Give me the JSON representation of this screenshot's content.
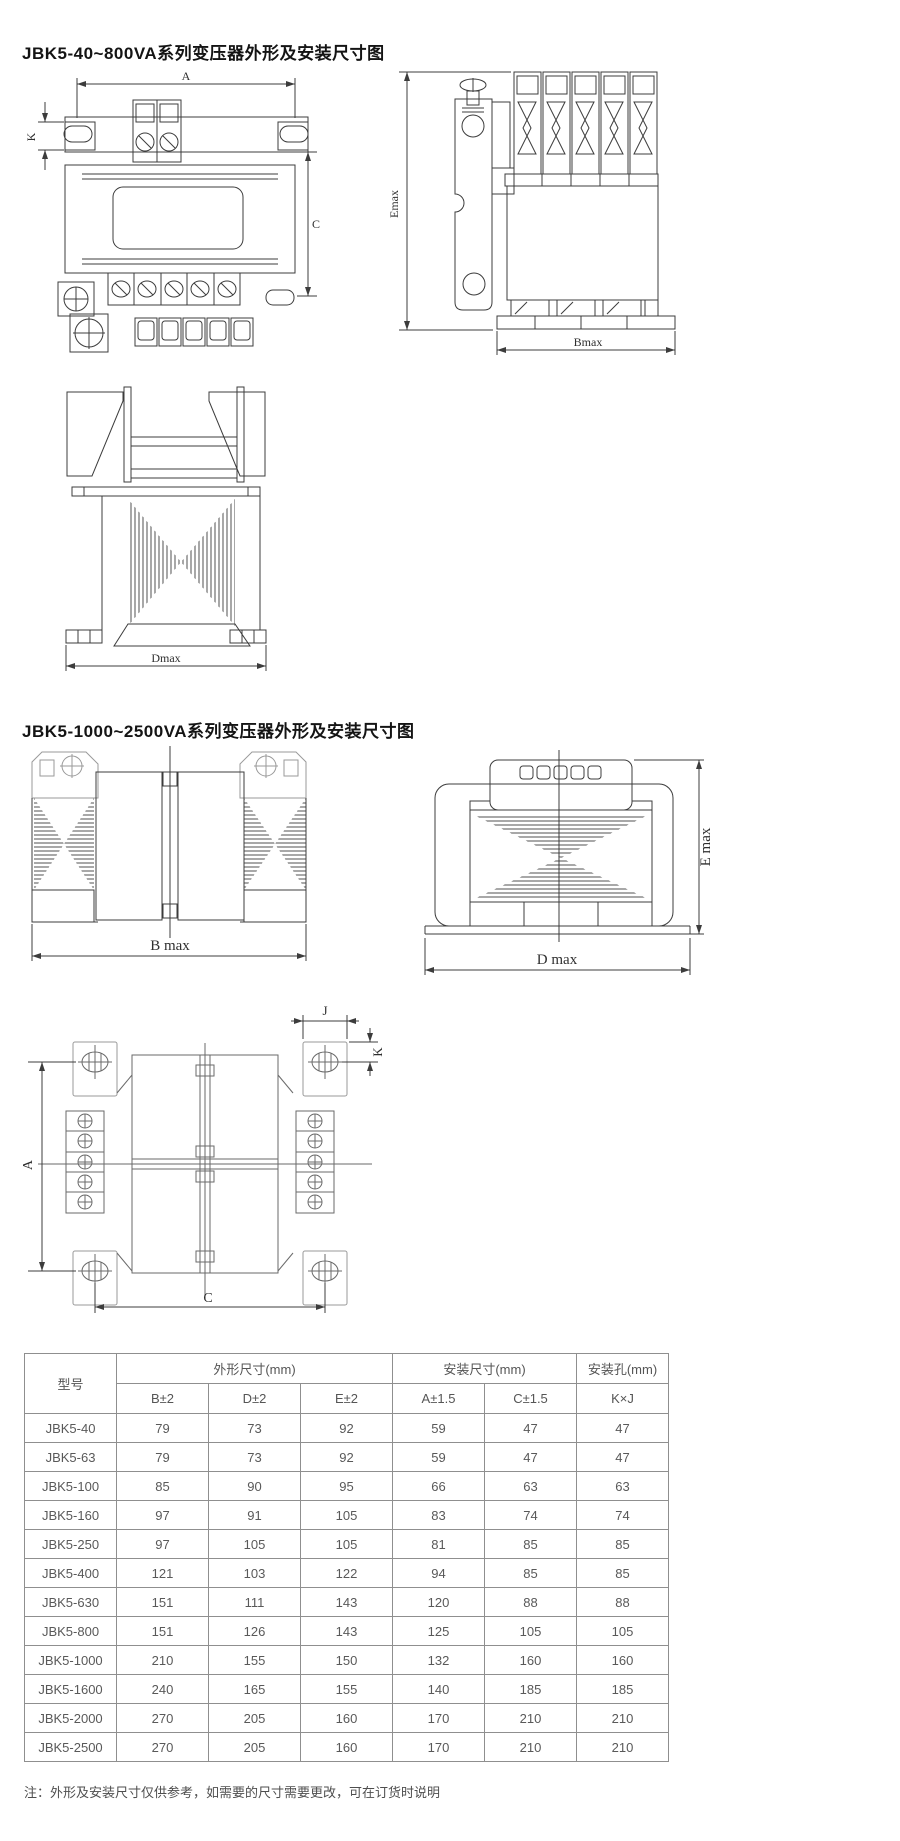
{
  "page": {
    "title_small_series": "JBK5-40~800VA系列变压器外形及安装尺寸图",
    "title_large_series": "JBK5-1000~2500VA系列变压器外形及安装尺寸图",
    "footnote": "注：外形及安装尺寸仅供参考，如需要的尺寸需要更改，可在订货时说明"
  },
  "colors": {
    "line": "#3c3c3c",
    "pad_grey": "#9a9a9a",
    "table_border": "#8f8f8f",
    "table_text": "#595959"
  },
  "dimensions": {
    "small_front": {
      "a": "A",
      "k": "K",
      "c": "C"
    },
    "small_side": {
      "emax": "Emax",
      "bmax": "Bmax"
    },
    "small_top": {
      "dmax": "Dmax"
    },
    "large_top": {
      "bmax": "B max"
    },
    "large_front": {
      "dmax": "D max",
      "emax": "E max"
    },
    "mounting": {
      "j": "J",
      "k": "K",
      "a": "A",
      "c": "C"
    }
  },
  "table": {
    "header_model": "型号",
    "group_outline": "外形尺寸(mm)",
    "group_mount": "安装尺寸(mm)",
    "group_hole": "安装孔(mm)",
    "sub": [
      "B±2",
      "D±2",
      "E±2",
      "A±1.5",
      "C±1.5",
      "K×J"
    ],
    "rows": [
      {
        "model": "JBK5-40",
        "b": "79",
        "d": "73",
        "e": "92",
        "a": "59",
        "c": "47",
        "kj": "47"
      },
      {
        "model": "JBK5-63",
        "b": "79",
        "d": "73",
        "e": "92",
        "a": "59",
        "c": "47",
        "kj": "47"
      },
      {
        "model": "JBK5-100",
        "b": "85",
        "d": "90",
        "e": "95",
        "a": "66",
        "c": "63",
        "kj": "63"
      },
      {
        "model": "JBK5-160",
        "b": "97",
        "d": "91",
        "e": "105",
        "a": "83",
        "c": "74",
        "kj": "74"
      },
      {
        "model": "JBK5-250",
        "b": "97",
        "d": "105",
        "e": "105",
        "a": "81",
        "c": "85",
        "kj": "85"
      },
      {
        "model": "JBK5-400",
        "b": "121",
        "d": "103",
        "e": "122",
        "a": "94",
        "c": "85",
        "kj": "85"
      },
      {
        "model": "JBK5-630",
        "b": "151",
        "d": "111",
        "e": "143",
        "a": "120",
        "c": "88",
        "kj": "88"
      },
      {
        "model": "JBK5-800",
        "b": "151",
        "d": "126",
        "e": "143",
        "a": "125",
        "c": "105",
        "kj": "105"
      },
      {
        "model": "JBK5-1000",
        "b": "210",
        "d": "155",
        "e": "150",
        "a": "132",
        "c": "160",
        "kj": "160"
      },
      {
        "model": "JBK5-1600",
        "b": "240",
        "d": "165",
        "e": "155",
        "a": "140",
        "c": "185",
        "kj": "185"
      },
      {
        "model": "JBK5-2000",
        "b": "270",
        "d": "205",
        "e": "160",
        "a": "170",
        "c": "210",
        "kj": "210"
      },
      {
        "model": "JBK5-2500",
        "b": "270",
        "d": "205",
        "e": "160",
        "a": "170",
        "c": "210",
        "kj": "210"
      }
    ]
  }
}
